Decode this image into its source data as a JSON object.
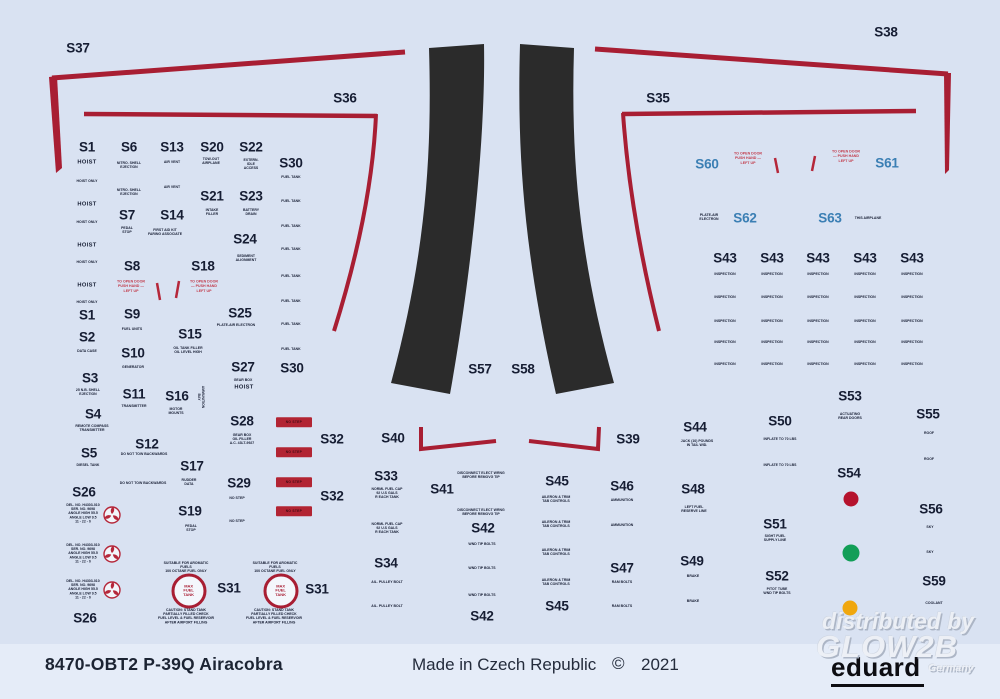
{
  "colors": {
    "bg": "#d9e2f2",
    "band": "#e5ecf8",
    "line_red": "#a81e33",
    "bar_red": "#b22433",
    "ink": "#161d33",
    "blue_label": "#3b7fb4",
    "red_text": "#c23a4a",
    "panel_black": "#2b2b2b",
    "dot_red": "#b5122d",
    "dot_green": "#129e57",
    "dot_yellow": "#f0a70e"
  },
  "footer": {
    "product_code": "8470-OBT2 P-39Q Airacobra",
    "made_in": "Made in Czech Republic",
    "copyright": "©",
    "year": "2021",
    "brand": "eduard"
  },
  "watermark": {
    "line1": "distributed by",
    "line2": "GLOW2B",
    "line3": "Germany"
  },
  "labels": [
    {
      "t": "S37",
      "x": 78,
      "y": 48
    },
    {
      "t": "S38",
      "x": 886,
      "y": 32
    },
    {
      "t": "S36",
      "x": 345,
      "y": 98
    },
    {
      "t": "S35",
      "x": 658,
      "y": 98
    },
    {
      "t": "S1",
      "x": 87,
      "y": 147
    },
    {
      "t": "S6",
      "x": 129,
      "y": 147
    },
    {
      "t": "S13",
      "x": 172,
      "y": 147
    },
    {
      "t": "S20",
      "x": 212,
      "y": 147
    },
    {
      "t": "S22",
      "x": 251,
      "y": 147
    },
    {
      "t": "S30",
      "x": 291,
      "y": 163
    },
    {
      "t": "S21",
      "x": 212,
      "y": 196
    },
    {
      "t": "S23",
      "x": 251,
      "y": 196
    },
    {
      "t": "S7",
      "x": 127,
      "y": 215
    },
    {
      "t": "S14",
      "x": 172,
      "y": 215
    },
    {
      "t": "S24",
      "x": 245,
      "y": 239
    },
    {
      "t": "S8",
      "x": 132,
      "y": 266
    },
    {
      "t": "S18",
      "x": 203,
      "y": 266
    },
    {
      "t": "S25",
      "x": 240,
      "y": 313
    },
    {
      "t": "S1",
      "x": 87,
      "y": 315
    },
    {
      "t": "S9",
      "x": 132,
      "y": 314
    },
    {
      "t": "S2",
      "x": 87,
      "y": 337
    },
    {
      "t": "S15",
      "x": 190,
      "y": 334
    },
    {
      "t": "S10",
      "x": 133,
      "y": 353
    },
    {
      "t": "S27",
      "x": 243,
      "y": 367
    },
    {
      "t": "S30",
      "x": 292,
      "y": 368
    },
    {
      "t": "S3",
      "x": 90,
      "y": 378
    },
    {
      "t": "S11",
      "x": 134,
      "y": 394
    },
    {
      "t": "S16",
      "x": 177,
      "y": 396
    },
    {
      "t": "S4",
      "x": 93,
      "y": 414
    },
    {
      "t": "S28",
      "x": 242,
      "y": 421
    },
    {
      "t": "S12",
      "x": 147,
      "y": 444
    },
    {
      "t": "S5",
      "x": 89,
      "y": 453
    },
    {
      "t": "S17",
      "x": 192,
      "y": 466
    },
    {
      "t": "S29",
      "x": 239,
      "y": 483
    },
    {
      "t": "S26",
      "x": 84,
      "y": 492
    },
    {
      "t": "S32",
      "x": 332,
      "y": 439
    },
    {
      "t": "S32",
      "x": 332,
      "y": 496
    },
    {
      "t": "S19",
      "x": 190,
      "y": 511
    },
    {
      "t": "S26",
      "x": 85,
      "y": 618
    },
    {
      "t": "S31",
      "x": 229,
      "y": 588
    },
    {
      "t": "S31",
      "x": 317,
      "y": 589
    },
    {
      "t": "S33",
      "x": 386,
      "y": 476
    },
    {
      "t": "S40",
      "x": 393,
      "y": 438
    },
    {
      "t": "S41",
      "x": 442,
      "y": 489
    },
    {
      "t": "S42",
      "x": 483,
      "y": 528
    },
    {
      "t": "S42",
      "x": 482,
      "y": 616
    },
    {
      "t": "S34",
      "x": 386,
      "y": 563
    },
    {
      "t": "S39",
      "x": 628,
      "y": 439
    },
    {
      "t": "S45",
      "x": 557,
      "y": 481
    },
    {
      "t": "S45",
      "x": 557,
      "y": 606
    },
    {
      "t": "S46",
      "x": 622,
      "y": 486
    },
    {
      "t": "S47",
      "x": 622,
      "y": 568
    },
    {
      "t": "S44",
      "x": 695,
      "y": 427
    },
    {
      "t": "S48",
      "x": 693,
      "y": 489
    },
    {
      "t": "S49",
      "x": 692,
      "y": 561
    },
    {
      "t": "S50",
      "x": 780,
      "y": 421
    },
    {
      "t": "S51",
      "x": 775,
      "y": 524
    },
    {
      "t": "S52",
      "x": 777,
      "y": 576
    },
    {
      "t": "S53",
      "x": 850,
      "y": 396
    },
    {
      "t": "S54",
      "x": 849,
      "y": 473
    },
    {
      "t": "S55",
      "x": 928,
      "y": 414
    },
    {
      "t": "S56",
      "x": 931,
      "y": 509
    },
    {
      "t": "S59",
      "x": 934,
      "y": 581
    },
    {
      "t": "S57",
      "x": 480,
      "y": 369
    },
    {
      "t": "S58",
      "x": 523,
      "y": 369
    },
    {
      "t": "S60",
      "x": 707,
      "y": 164,
      "c": "blue"
    },
    {
      "t": "S61",
      "x": 887,
      "y": 163,
      "c": "blue"
    },
    {
      "t": "S62",
      "x": 745,
      "y": 218,
      "c": "blue"
    },
    {
      "t": "S63",
      "x": 830,
      "y": 218,
      "c": "blue"
    }
  ],
  "small_texts": [
    {
      "t": "HOIST",
      "x": 87,
      "y": 162
    },
    {
      "t": "HOIST",
      "x": 87,
      "y": 204
    },
    {
      "t": "HOIST",
      "x": 87,
      "y": 245
    },
    {
      "t": "HOIST",
      "x": 87,
      "y": 285
    },
    {
      "t": "HOIST",
      "x": 244,
      "y": 387
    }
  ],
  "red_texts": [
    {
      "t": "TO OPEN DOOR\nPUSH HAND —\nLEFT UP",
      "x": 131,
      "y": 287
    },
    {
      "t": "TO OPEN DOOR\n— PUSH HAND\nLEFT UP",
      "x": 204,
      "y": 287
    },
    {
      "t": "TO OPEN DOOR\nPUSH HAND —\nLEFT UP",
      "x": 748,
      "y": 159
    },
    {
      "t": "TO OPEN DOOR\n— PUSH HAND\nLEFT UP",
      "x": 846,
      "y": 157
    }
  ],
  "micro_texts": [
    {
      "t": "HOIST ONLY",
      "x": 87,
      "y": 182
    },
    {
      "t": "HOIST ONLY",
      "x": 87,
      "y": 223
    },
    {
      "t": "HOIST ONLY",
      "x": 87,
      "y": 263
    },
    {
      "t": "HOIST ONLY",
      "x": 87,
      "y": 303
    },
    {
      "t": "NITRO. SHELL\nEJECTION",
      "x": 129,
      "y": 166
    },
    {
      "t": "NITRO. SHELL\nEJECTION",
      "x": 129,
      "y": 193
    },
    {
      "t": "AIR VENT",
      "x": 172,
      "y": 163
    },
    {
      "t": "AIR VENT",
      "x": 172,
      "y": 188
    },
    {
      "t": "TOW-OUT\nAIRPLANE",
      "x": 211,
      "y": 162
    },
    {
      "t": "EXTERN.\nIDLE\nACCESS",
      "x": 251,
      "y": 165
    },
    {
      "t": "INTAKE\nFILLER",
      "x": 212,
      "y": 213
    },
    {
      "t": "BATTERY\nDRAIN",
      "x": 251,
      "y": 213
    },
    {
      "t": "PEDAL\nSTOP",
      "x": 127,
      "y": 231
    },
    {
      "t": "FIRST AID KIT\nFARING ASSOCIATE",
      "x": 165,
      "y": 233
    },
    {
      "t": "SEDIMENT\nALIGNMENT",
      "x": 246,
      "y": 259
    },
    {
      "t": "FUEL UNITS",
      "x": 132,
      "y": 330
    },
    {
      "t": "PLATE-AIR ELECTRON",
      "x": 236,
      "y": 326
    },
    {
      "t": "DATA CASE",
      "x": 87,
      "y": 352
    },
    {
      "t": "OIL TANK FILLER\nOIL LEVEL HIGH",
      "x": 188,
      "y": 351
    },
    {
      "t": "GENERATOR",
      "x": 133,
      "y": 368
    },
    {
      "t": "GEAR BOX",
      "x": 243,
      "y": 381
    },
    {
      "t": "25 N.B. SHELL\nEJECTION",
      "x": 88,
      "y": 393
    },
    {
      "t": "TRANSMITTER",
      "x": 134,
      "y": 407
    },
    {
      "t": "MOTOR\nMOUNTS",
      "x": 176,
      "y": 412
    },
    {
      "t": "AMMUNITION\nBAY",
      "x": 200,
      "y": 397,
      "r": 90
    },
    {
      "t": "REMOTE COMPASS\nTRANSMITTER",
      "x": 92,
      "y": 429
    },
    {
      "t": "GEAR BOX\nOIL FILLER\nA.C. 43LT-9927",
      "x": 242,
      "y": 440
    },
    {
      "t": "DO NOT TOW BACKWARDS",
      "x": 144,
      "y": 455
    },
    {
      "t": "DIESEL TANK",
      "x": 88,
      "y": 466
    },
    {
      "t": "RUDDER\nDATA",
      "x": 189,
      "y": 483
    },
    {
      "t": "DO NOT TOW BACKWARDS",
      "x": 143,
      "y": 484
    },
    {
      "t": "NO STEP",
      "x": 237,
      "y": 499
    },
    {
      "t": "NO STEP",
      "x": 237,
      "y": 522
    },
    {
      "t": "PEDAL\nSTOP",
      "x": 191,
      "y": 529
    },
    {
      "t": "DEL. NO. H4303-010\nSER. NO. 9698\nANGLE HIGH 55.5\nANGLE LOW 9.5\n11 - 22 - 0",
      "x": 83,
      "y": 514
    },
    {
      "t": "DEL. NO. H4303-010\nSER. NO. 9698\nANGLE HIGH 55.5\nANGLE LOW 9.5\n11 - 22 - 0",
      "x": 83,
      "y": 554
    },
    {
      "t": "DEL. NO. H4303-010\nSER. NO. 9698\nANGLE HIGH 55.5\nANGLE LOW 9.5\n11 - 22 - 0",
      "x": 83,
      "y": 590
    },
    {
      "t": "SUITABLE FOR AROMATIC\nFUELS\n100 OCTANE FUEL ONLY",
      "x": 186,
      "y": 568
    },
    {
      "t": "SUITABLE FOR AROMATIC\nFUELS\n100 OCTANE FUEL ONLY",
      "x": 275,
      "y": 568
    },
    {
      "t": "CAUTION: STAND TANK\nPARTIALLY FILLED CHECK\nFUEL LEVEL & FUEL RESERVOIR\nAFTER AIRPORT FILLING",
      "x": 186,
      "y": 617
    },
    {
      "t": "CAUTION: STAND TANK\nPARTIALLY FILLED CHECK\nFUEL LEVEL & FUEL RESERVOIR\nAFTER AIRPORT FILLING",
      "x": 274,
      "y": 617
    },
    {
      "t": "FUEL TANK",
      "x": 291,
      "y": 178
    },
    {
      "t": "FUEL TANK",
      "x": 291,
      "y": 202
    },
    {
      "t": "FUEL TANK",
      "x": 291,
      "y": 227
    },
    {
      "t": "FUEL TANK",
      "x": 291,
      "y": 250
    },
    {
      "t": "FUEL TANK",
      "x": 291,
      "y": 277
    },
    {
      "t": "FUEL TANK",
      "x": 291,
      "y": 302
    },
    {
      "t": "FUEL TANK",
      "x": 291,
      "y": 325
    },
    {
      "t": "FUEL TANK",
      "x": 291,
      "y": 350
    },
    {
      "t": "NORML FUEL CAP\n92 U.S GALS\nR EACH TANK",
      "x": 387,
      "y": 494
    },
    {
      "t": "NORML FUEL CAP\n92 U.S GALS\nR EACH TANK",
      "x": 387,
      "y": 529
    },
    {
      "t": "DISCONNECT ELECT WRNG\nBEFORE REMOVG TIP",
      "x": 481,
      "y": 476
    },
    {
      "t": "DISCONNECT ELECT WRNG\nBEFORE REMOVG TIP",
      "x": 481,
      "y": 513
    },
    {
      "t": "WND TIP BOLTS",
      "x": 482,
      "y": 545
    },
    {
      "t": "WND TIP BOLTS",
      "x": 482,
      "y": 569
    },
    {
      "t": "WND TIP BOLTS",
      "x": 482,
      "y": 596
    },
    {
      "t": "AIL. PULLEY BOLT",
      "x": 387,
      "y": 583
    },
    {
      "t": "AIL. PULLEY BOLT",
      "x": 387,
      "y": 607
    },
    {
      "t": "AILERON & TRIM\nTAB CONTROLS",
      "x": 556,
      "y": 500
    },
    {
      "t": "AILERON & TRIM\nTAB CONTROLS",
      "x": 556,
      "y": 525
    },
    {
      "t": "AILERON & TRIM\nTAB CONTROLS",
      "x": 556,
      "y": 553
    },
    {
      "t": "AILERON & TRIM\nTAB CONTROLS",
      "x": 556,
      "y": 583
    },
    {
      "t": "AMMUNITION",
      "x": 622,
      "y": 501
    },
    {
      "t": "AMMUNITION",
      "x": 622,
      "y": 526
    },
    {
      "t": "RAM BOLTS",
      "x": 622,
      "y": 583
    },
    {
      "t": "RAM BOLTS",
      "x": 622,
      "y": 607
    },
    {
      "t": "JACK (10) POUNDS\nIN TAIL WID.",
      "x": 697,
      "y": 444
    },
    {
      "t": "LEFT FUEL\nRESERVE LINE",
      "x": 694,
      "y": 510
    },
    {
      "t": "BRAKE",
      "x": 693,
      "y": 577
    },
    {
      "t": "BRAKE",
      "x": 693,
      "y": 602
    },
    {
      "t": "INFLATE TO 70 LBS",
      "x": 780,
      "y": 440
    },
    {
      "t": "INFLATE TO 70 LBS",
      "x": 780,
      "y": 466
    },
    {
      "t": "SIGHT FUEL\nSUPPLY LINE",
      "x": 775,
      "y": 539
    },
    {
      "t": "PITOT TUBE\nWND TIP BOLTS",
      "x": 777,
      "y": 592
    },
    {
      "t": "ACTUATING\nREAR DOORS",
      "x": 850,
      "y": 417
    },
    {
      "t": "ROOF",
      "x": 929,
      "y": 434
    },
    {
      "t": "ROOF",
      "x": 929,
      "y": 460
    },
    {
      "t": "SKY",
      "x": 930,
      "y": 528
    },
    {
      "t": "SKY",
      "x": 930,
      "y": 553
    },
    {
      "t": "COOLANT",
      "x": 934,
      "y": 604
    },
    {
      "t": "PLATE-AIR\nELECTRON",
      "x": 709,
      "y": 218
    },
    {
      "t": "THIS AIRPLANE",
      "x": 868,
      "y": 219
    }
  ],
  "inspection": {
    "label": "S43",
    "cell": "INSPECTION",
    "cols": [
      725,
      772,
      818,
      865,
      912
    ],
    "label_y": 258,
    "rows": [
      275,
      298,
      322,
      343,
      365
    ]
  },
  "no_step": {
    "text": "NO STEP",
    "positions": [
      {
        "x": 294,
        "y": 422
      },
      {
        "x": 294,
        "y": 452
      },
      {
        "x": 294,
        "y": 482
      },
      {
        "x": 294,
        "y": 511
      }
    ]
  },
  "max_fuel": {
    "text": "MAX\nFUEL\nTANK",
    "positions": [
      {
        "x": 189,
        "y": 591
      },
      {
        "x": 281,
        "y": 591
      }
    ]
  },
  "dots": [
    {
      "x": 851,
      "y": 499,
      "d": 15,
      "c": "#b5122d"
    },
    {
      "x": 851,
      "y": 553,
      "d": 17,
      "c": "#129e57"
    },
    {
      "x": 850,
      "y": 608,
      "d": 15,
      "c": "#f0a70e"
    }
  ]
}
